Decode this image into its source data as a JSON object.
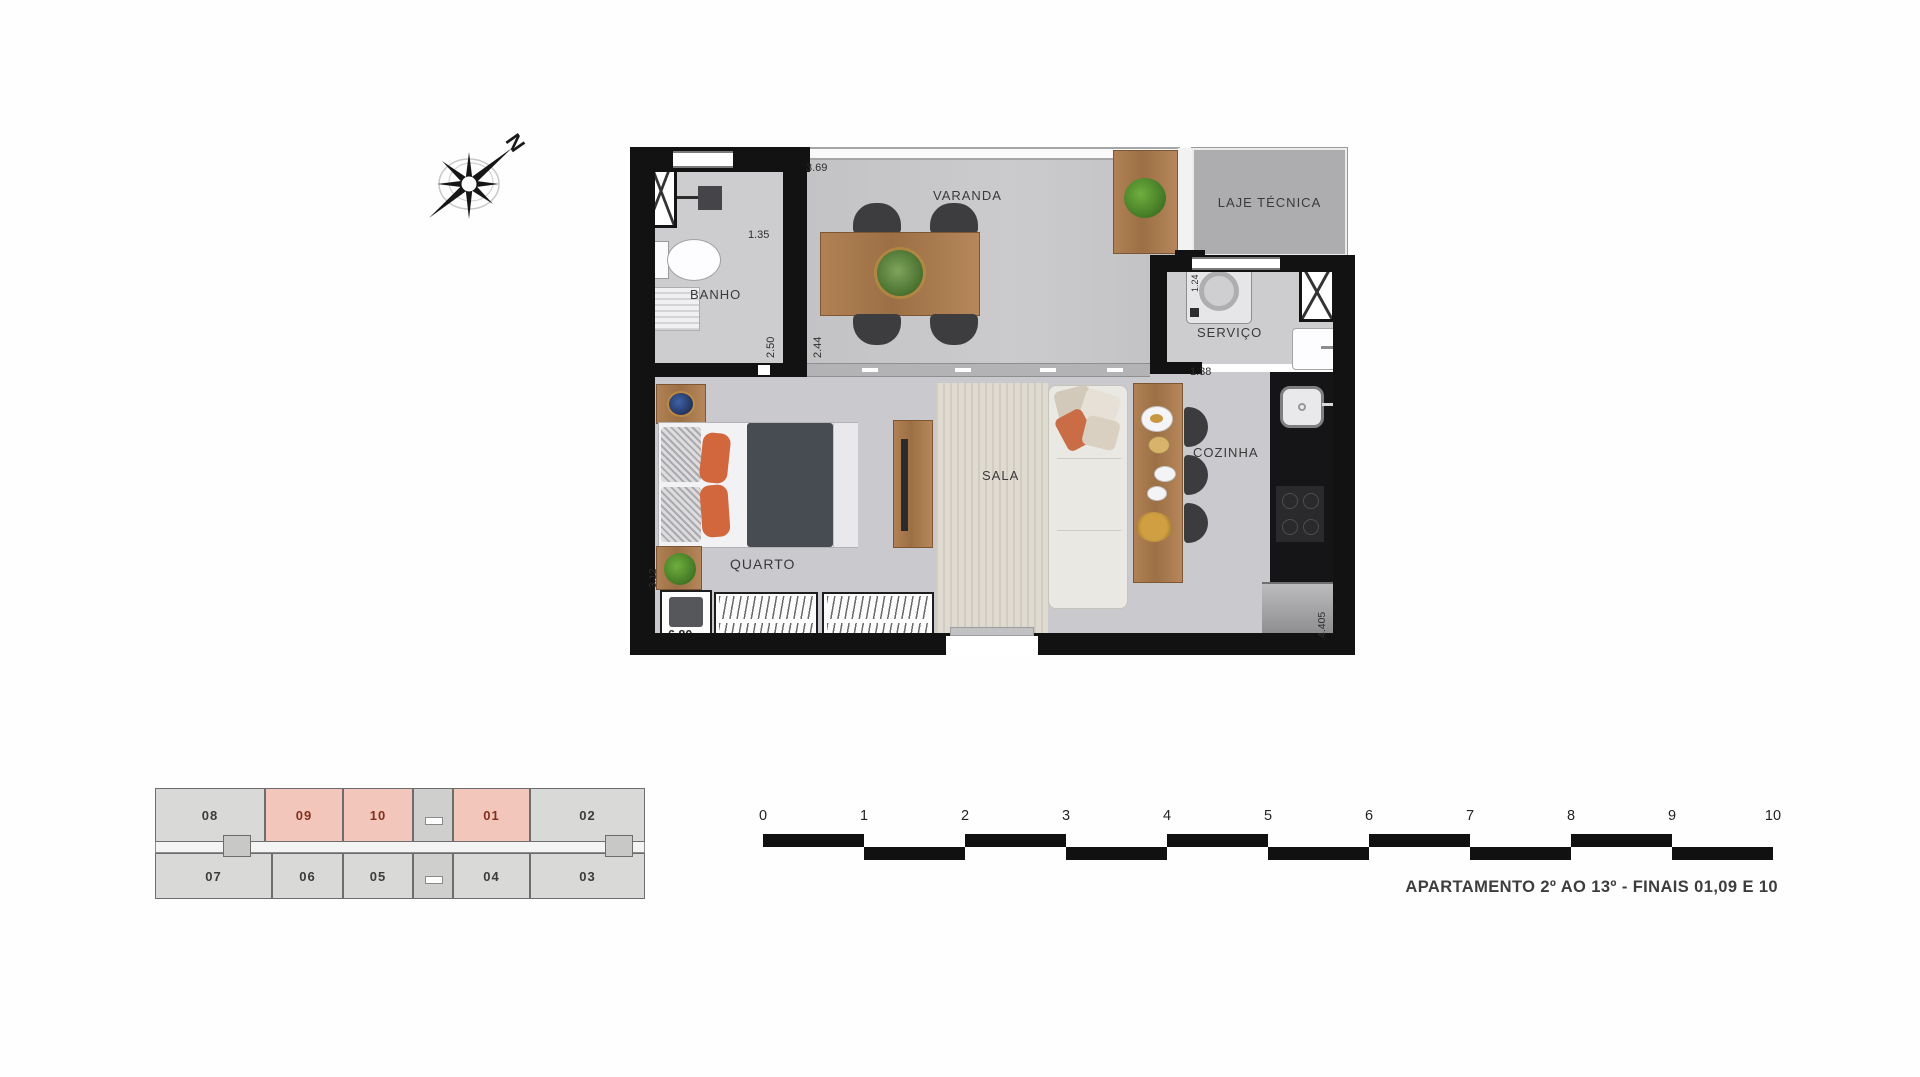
{
  "compass": {
    "north_label": "N"
  },
  "plan": {
    "room_labels": {
      "banho": "BANHO",
      "varanda": "VARANDA",
      "laje_tecnica": "LAJE TÉCNICA",
      "servico": "SERVIÇO",
      "sala": "SALA",
      "cozinha": "COZINHA",
      "quarto": "QUARTO"
    },
    "dimensions": {
      "varanda_width": "3.69",
      "banho_width": "1.35",
      "banho_depth": "2.50",
      "varanda_depth": "2.44",
      "servico_machine": "1.24",
      "servico_width": "1.38",
      "quarto_depth": "3.12",
      "quarto_width": "6.80",
      "cozinha_depth": "4.405"
    }
  },
  "keyplan": {
    "units": [
      {
        "label": "08",
        "highlighted": false
      },
      {
        "label": "09",
        "highlighted": true
      },
      {
        "label": "10",
        "highlighted": true
      },
      {
        "label": "01",
        "highlighted": true
      },
      {
        "label": "02",
        "highlighted": false
      },
      {
        "label": "07",
        "highlighted": false
      },
      {
        "label": "06",
        "highlighted": false
      },
      {
        "label": "05",
        "highlighted": false
      },
      {
        "label": "04",
        "highlighted": false
      },
      {
        "label": "03",
        "highlighted": false
      }
    ]
  },
  "scalebar": {
    "ticks": [
      "0",
      "1",
      "2",
      "3",
      "4",
      "5",
      "6",
      "7",
      "8",
      "9",
      "10"
    ]
  },
  "caption": "APARTAMENTO 2º AO 13º - FINAIS 01,09 E 10",
  "colors": {
    "wall": "#121212",
    "floor": "#cacace",
    "wood": "#a87a4e",
    "unit_gray": "#d9d9d7",
    "unit_highlight": "#f2c6ba",
    "highlight_text": "#83301f",
    "accent_orange": "#d2673e"
  }
}
